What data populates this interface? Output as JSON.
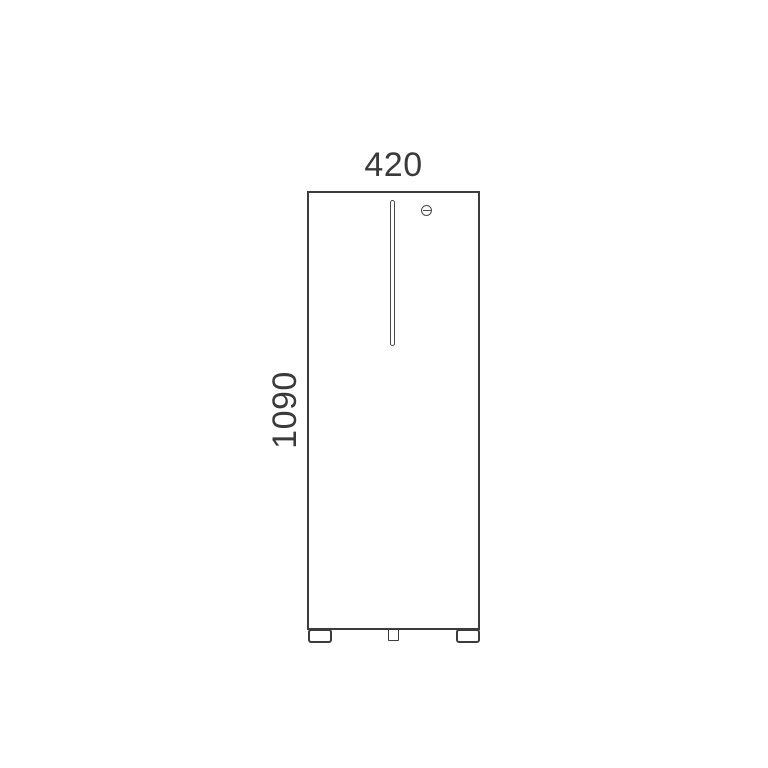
{
  "drawing": {
    "type": "technical-elevation",
    "subject": "cabinet front view with door handle, cylinder lock and feet",
    "dimensions": {
      "width_label": "420",
      "height_label": "1090"
    },
    "colors": {
      "background": "#ffffff",
      "outline": "#3c3c3c",
      "detail_line": "#4b4b4b",
      "text": "#3a3a3a"
    },
    "icons": [
      {
        "name": "lock-icon",
        "glyph": "circle-with-horizontal-slot"
      },
      {
        "name": "door-handle",
        "glyph": "thin-vertical-outlined-bar"
      }
    ]
  }
}
